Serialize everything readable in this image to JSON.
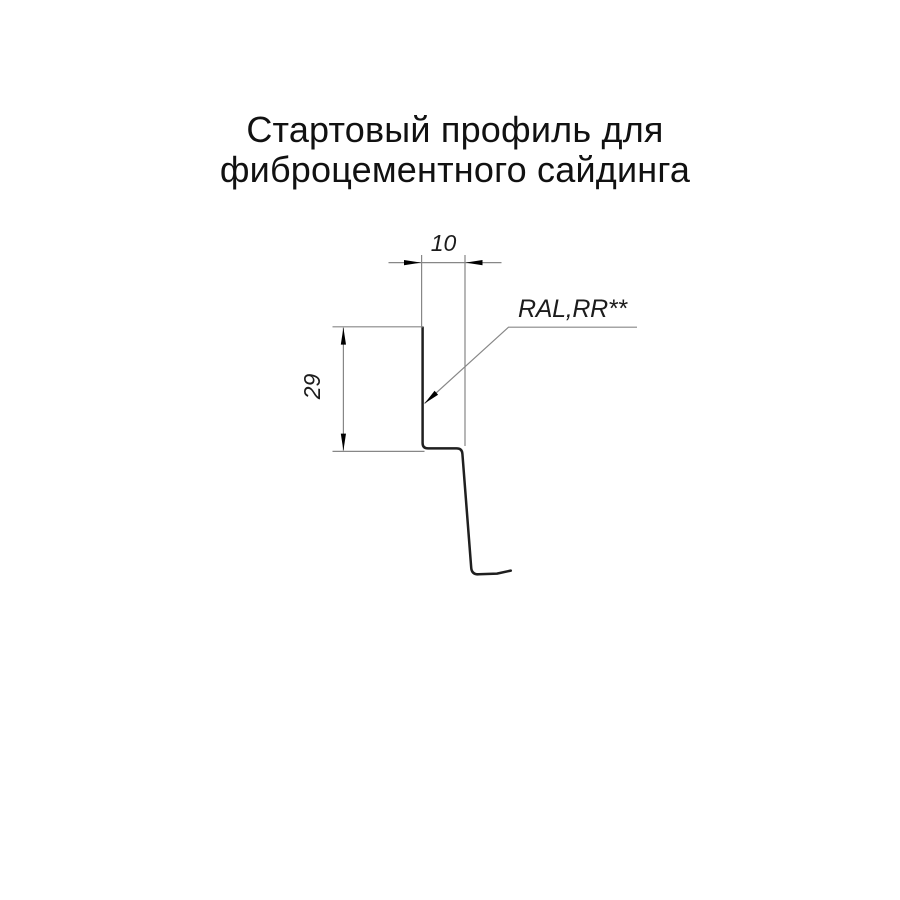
{
  "title": {
    "line1": "Стартовый профиль для",
    "line2": "фиброцементного сайдинга"
  },
  "drawing": {
    "dim_width": {
      "value": "10"
    },
    "dim_height": {
      "value": "29"
    },
    "material_label": "RAL,RR**"
  },
  "colors": {
    "background": "#ffffff",
    "title_text": "#111111",
    "profile_line": "#1f1f1f",
    "dimension_line": "#878787",
    "dimension_text": "#1c1c1c",
    "arrowhead": "#000000"
  }
}
